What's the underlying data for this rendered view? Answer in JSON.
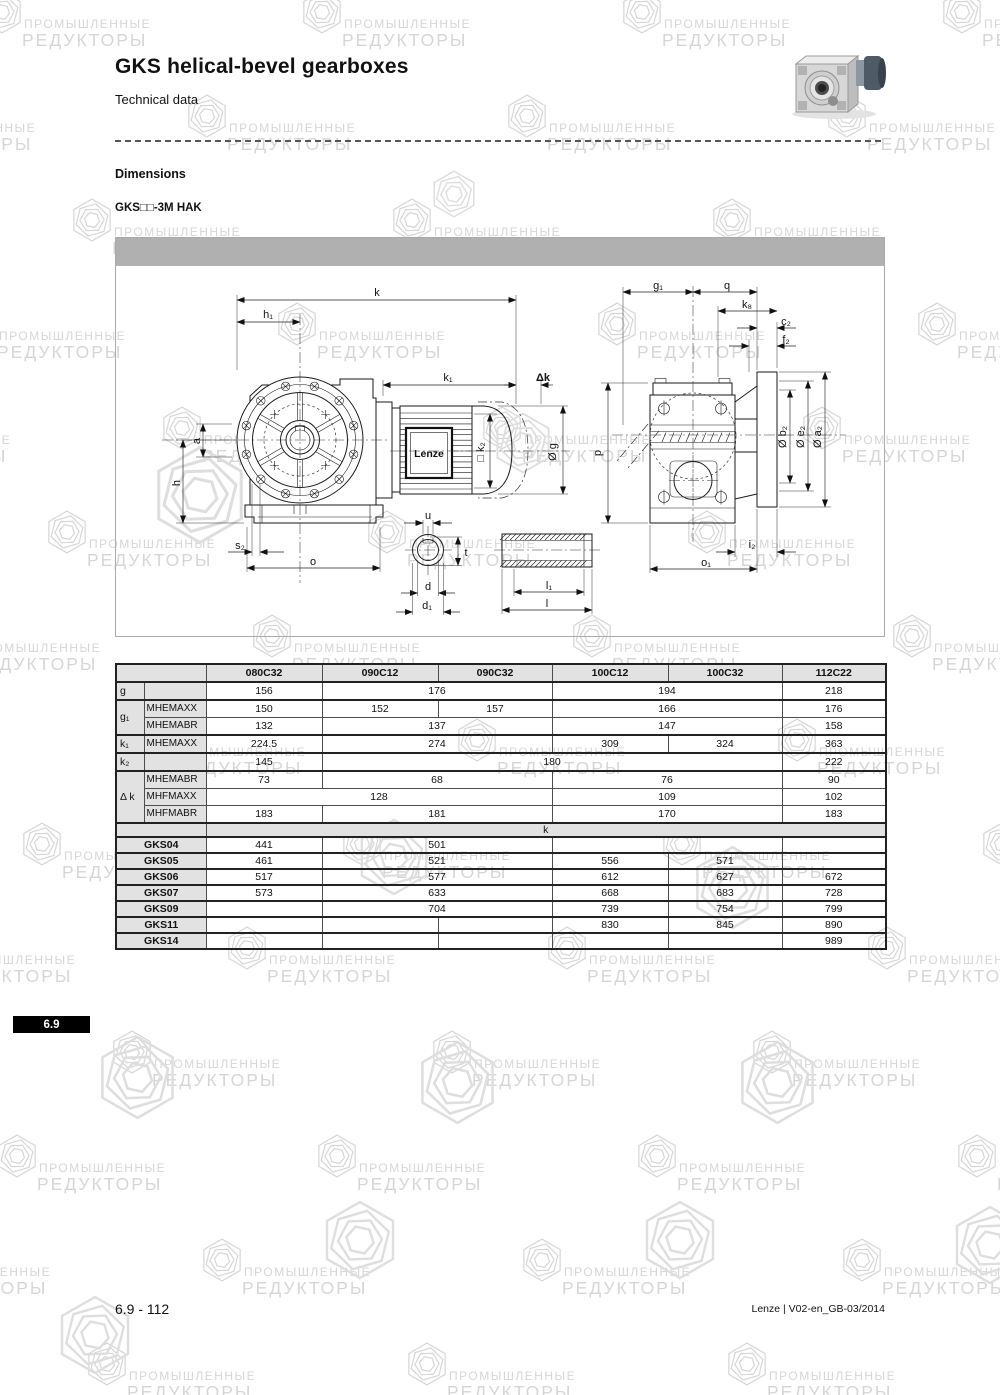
{
  "page": {
    "title": "GKS helical-bevel gearboxes",
    "subtitle": "Technical data",
    "section_heading": "Dimensions",
    "variant_label": "GKS□□-3M HAK",
    "tab_label": "6.9",
    "footer_left": "6.9 - 112",
    "footer_right": "Lenze | V02-en_GB-03/2014"
  },
  "watermark": {
    "line1": "ПРОМЫШЛЕННЫЕ",
    "line2": "РЕДУКТОРЫ",
    "color": "#d6d6d6"
  },
  "drawing": {
    "brand_label": "Lenze",
    "labels": {
      "k": "k",
      "h1": "h₁",
      "k1": "k₁",
      "dk": "Δk",
      "a": "a",
      "h": "h",
      "s2": "s₂",
      "o": "o",
      "u": "u",
      "t": "t",
      "d": "d",
      "d1": "d₁",
      "l1": "l₁",
      "l": "l",
      "k2sq": "□ k₂",
      "g": "Ø g",
      "p": "p",
      "g1": "g₁",
      "q": "q",
      "k8": "k₈",
      "c2": "c₂",
      "f2": "f₂",
      "b2": "Ø b₂",
      "e2": "Ø e₂",
      "a2": "Ø a₂",
      "i2": "i₂",
      "o1": "o₁"
    }
  },
  "table": {
    "columns": [
      "080C32",
      "090C12",
      "090C32",
      "100C12",
      "100C32",
      "112C22"
    ],
    "dim_rows": [
      {
        "dim": "g",
        "sub": "",
        "first": true,
        "rowspan": 1,
        "cells": [
          [
            "156",
            1
          ],
          [
            "176",
            2
          ],
          [
            "194",
            2
          ],
          [
            "218",
            1
          ]
        ]
      },
      {
        "dim": "g₁",
        "sub": "MHEMAXX",
        "first": true,
        "rowspan": 2,
        "cells": [
          [
            "150",
            1
          ],
          [
            "152",
            1
          ],
          [
            "157",
            1
          ],
          [
            "166",
            2
          ],
          [
            "176",
            1
          ]
        ]
      },
      {
        "sub": "MHEMABR",
        "cells": [
          [
            "132",
            1
          ],
          [
            "137",
            2
          ],
          [
            "147",
            2
          ],
          [
            "158",
            1
          ]
        ]
      },
      {
        "dim": "k₁",
        "sub": "MHEMAXX",
        "first": true,
        "rowspan": 1,
        "cells": [
          [
            "224.5",
            1
          ],
          [
            "274",
            2
          ],
          [
            "309",
            1
          ],
          [
            "324",
            1
          ],
          [
            "363",
            1
          ]
        ]
      },
      {
        "dim": "k₂",
        "sub": "",
        "first": true,
        "rowspan": 1,
        "cells": [
          [
            "145",
            1
          ],
          [
            "180",
            4
          ],
          [
            "222",
            1
          ]
        ]
      },
      {
        "dim": "Δ k",
        "sub": "MHEMABR",
        "first": true,
        "rowspan": 3,
        "cells": [
          [
            "73",
            1
          ],
          [
            "68",
            2
          ],
          [
            "76",
            2
          ],
          [
            "90",
            1
          ]
        ]
      },
      {
        "sub": "MHFMAXX",
        "cells": [
          [
            "128",
            3
          ],
          [
            "109",
            2
          ],
          [
            "102",
            1
          ]
        ]
      },
      {
        "sub": "MHFMABR",
        "cells": [
          [
            "183",
            1
          ],
          [
            "181",
            2
          ],
          [
            "170",
            2
          ],
          [
            "183",
            1
          ]
        ]
      }
    ],
    "k_section_label": "k",
    "gks_rows": [
      {
        "label": "GKS04",
        "cells": [
          [
            "441",
            1
          ],
          [
            "501",
            2
          ],
          [
            "",
            2
          ],
          [
            "",
            1
          ]
        ]
      },
      {
        "label": "GKS05",
        "cells": [
          [
            "461",
            1
          ],
          [
            "521",
            2
          ],
          [
            "556",
            1
          ],
          [
            "571",
            1
          ],
          [
            "",
            1
          ]
        ]
      },
      {
        "label": "GKS06",
        "cells": [
          [
            "517",
            1
          ],
          [
            "577",
            2
          ],
          [
            "612",
            1
          ],
          [
            "627",
            1
          ],
          [
            "672",
            1
          ]
        ]
      },
      {
        "label": "GKS07",
        "cells": [
          [
            "573",
            1
          ],
          [
            "633",
            2
          ],
          [
            "668",
            1
          ],
          [
            "683",
            1
          ],
          [
            "728",
            1
          ]
        ]
      },
      {
        "label": "GKS09",
        "cells": [
          [
            "",
            1
          ],
          [
            "704",
            2
          ],
          [
            "739",
            1
          ],
          [
            "754",
            1
          ],
          [
            "799",
            1
          ]
        ]
      },
      {
        "label": "GKS11",
        "cells": [
          [
            "",
            1
          ],
          [
            "",
            1
          ],
          [
            "",
            1
          ],
          [
            "830",
            1
          ],
          [
            "845",
            1
          ],
          [
            "890",
            1
          ]
        ]
      },
      {
        "label": "GKS14",
        "cells": [
          [
            "",
            1
          ],
          [
            "",
            1
          ],
          [
            "",
            1
          ],
          [
            "",
            1
          ],
          [
            "",
            1
          ],
          [
            "989",
            1
          ]
        ]
      }
    ]
  }
}
